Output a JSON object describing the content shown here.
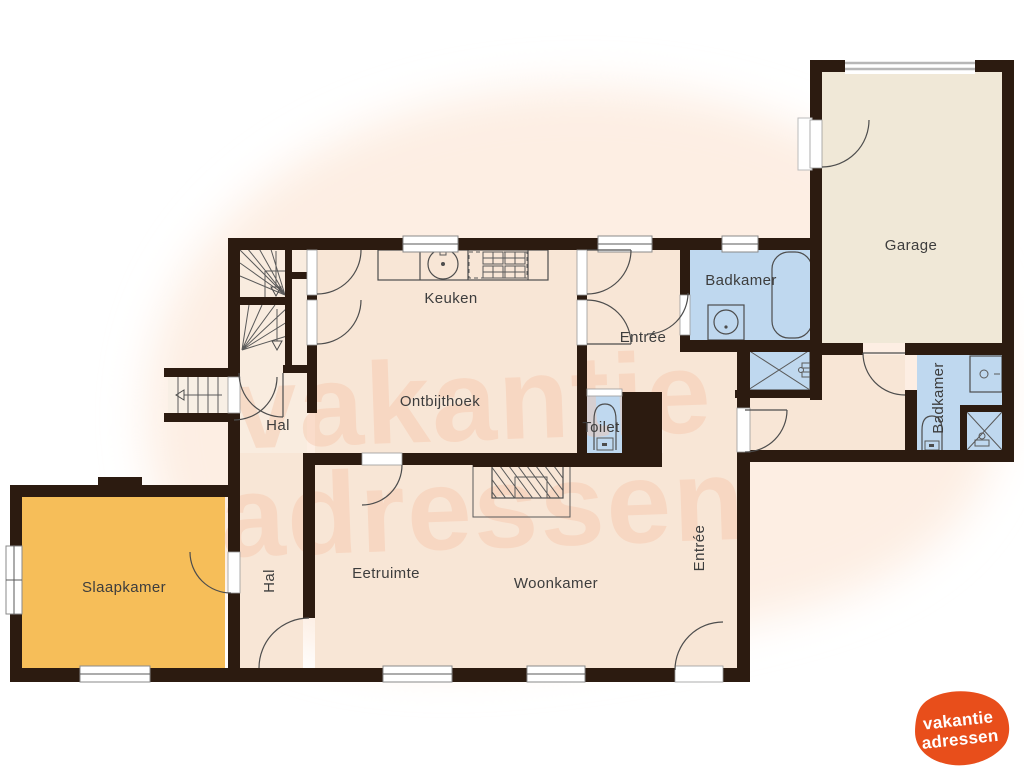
{
  "title": "Floor plan",
  "watermark": {
    "line1": "vakantie",
    "line2": "adressen"
  },
  "logo": {
    "line1": "vakantie",
    "line2": "adressen",
    "color": "#e84e1b",
    "text_color": "#ffffff"
  },
  "palette": {
    "wall": "#2c1b10",
    "room": "#f8e6d6",
    "bedroom": "#f6be59",
    "bathroom": "#bfd8ef",
    "garage": "#f0e8d7",
    "watermark": "#f6c4a8",
    "label_text": "#3d3d3d",
    "background_blob": "#fdeee3"
  },
  "rooms": [
    {
      "id": "keuken",
      "label": "Keuken"
    },
    {
      "id": "ontbijthoek",
      "label": "Ontbijthoek"
    },
    {
      "id": "hal-boven",
      "label": "Hal"
    },
    {
      "id": "entree-boven",
      "label": "Entrée"
    },
    {
      "id": "badkamer-boven",
      "label": "Badkamer"
    },
    {
      "id": "garage",
      "label": "Garage"
    },
    {
      "id": "toilet",
      "label": "Toilet"
    },
    {
      "id": "badkamer-rechts",
      "label": "Badkamer"
    },
    {
      "id": "slaapkamer",
      "label": "Slaapkamer"
    },
    {
      "id": "hal-beneden",
      "label": "Hal"
    },
    {
      "id": "eetruimte",
      "label": "Eetruimte"
    },
    {
      "id": "woonkamer",
      "label": "Woonkamer"
    },
    {
      "id": "entree-gang",
      "label": "Entrée"
    }
  ]
}
